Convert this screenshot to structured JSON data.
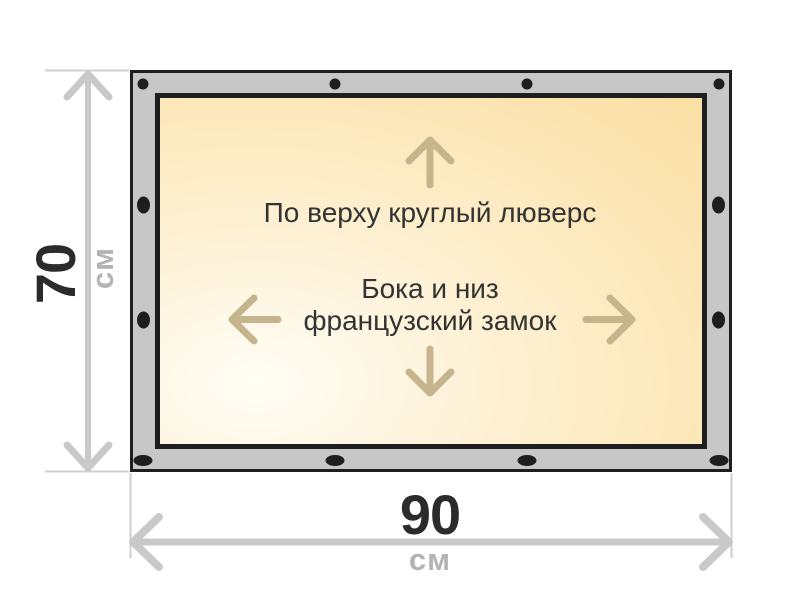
{
  "diagram": {
    "title_semantic": "banner-size-specification",
    "canvas_notes": {
      "top": "По верху круглый люверс",
      "center_line1": "Бока и низ",
      "center_line2": "французский замок"
    },
    "dimensions": {
      "height": {
        "value": "70",
        "unit": "см"
      },
      "width": {
        "value": "90",
        "unit": "см"
      }
    },
    "fasteners": {
      "top_edge": "round-grommet",
      "sides_and_bottom": "french-lock",
      "top_dot_count": 4,
      "bottom_dot_count": 4,
      "left_dot_count": 2,
      "right_dot_count": 2
    },
    "icons": {
      "round-grommet-icon": "●",
      "french-lock-icon": "⬮",
      "arrow-up-icon": "↑",
      "arrow-down-icon": "↓",
      "arrow-left-icon": "←",
      "arrow-right-icon": "→"
    },
    "colors": {
      "background": "#ffffff",
      "frame_fill": "#c7c7c7",
      "frame_stroke": "#1e1e1e",
      "canvas_light": "#fffdf6",
      "canvas_mid": "#fdedc9",
      "canvas_peach": "#fbdfa3",
      "fastener": "#1e1e1e",
      "inner_arrow": "#c5b48c",
      "dimension_gray": "#c9c9c9",
      "extension_line": "#cfcfcf",
      "value_text": "#2b2b2b",
      "unit_text": "#b3b3b3",
      "note_text": "#333333"
    }
  }
}
